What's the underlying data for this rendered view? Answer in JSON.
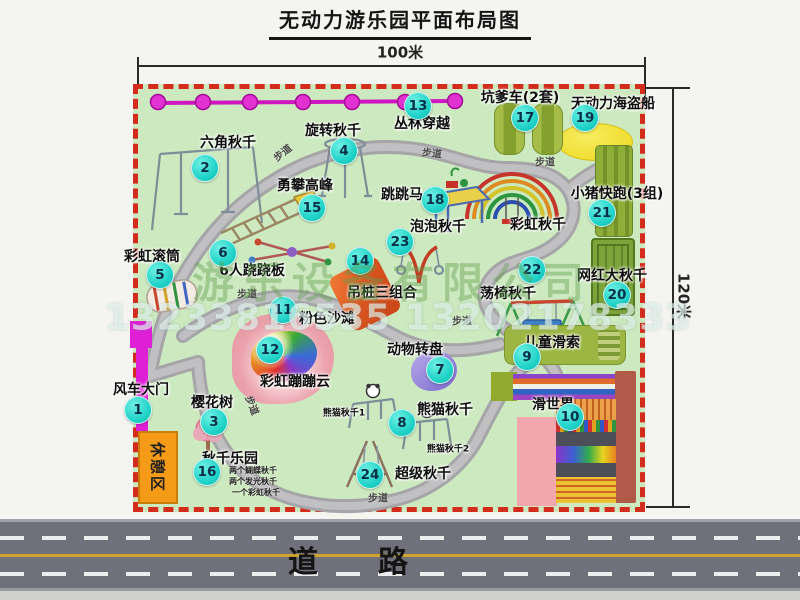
{
  "title": "无动力游乐园平面布局图",
  "dimensions": {
    "width": "100米",
    "height": "120米"
  },
  "road_label": "道　　路",
  "watermark": {
    "company": "游乐设备有限公司",
    "phone": "13233816535 13202178333"
  },
  "park": {
    "rest_area": "休憩区",
    "path_label": "步道",
    "rainbow_swing": "彩虹秋千",
    "panda_swing_1": "熊猫秋千1",
    "panda_swing_2": "熊猫秋千2",
    "swing_park_notes": [
      "两个蝴蝶秋千",
      "两个发光秋千",
      "一个彩虹秋千"
    ]
  },
  "markers": [
    {
      "num": "1",
      "label": "风车大门"
    },
    {
      "num": "2",
      "label": "六角秋千"
    },
    {
      "num": "3",
      "label": "樱花树"
    },
    {
      "num": "4",
      "label": "旋转秋千"
    },
    {
      "num": "5",
      "label": "彩虹滚筒"
    },
    {
      "num": "6",
      "label": "6人跷跷板"
    },
    {
      "num": "7",
      "label": "动物转盘"
    },
    {
      "num": "8",
      "label": "熊猫秋千"
    },
    {
      "num": "9",
      "label": "儿童滑索"
    },
    {
      "num": "10",
      "label": "滑世界"
    },
    {
      "num": "11",
      "label": "粉色沙滩"
    },
    {
      "num": "12",
      "label": "彩虹蹦蹦云"
    },
    {
      "num": "13",
      "label": "丛林穿越"
    },
    {
      "num": "14",
      "label": "吊桩三组合"
    },
    {
      "num": "15",
      "label": "勇攀高峰"
    },
    {
      "num": "16",
      "label": "秋千乐园"
    },
    {
      "num": "17",
      "label": "坑爹车(2套)"
    },
    {
      "num": "18",
      "label": "跳跳马"
    },
    {
      "num": "19",
      "label": "无动力海盗船"
    },
    {
      "num": "20",
      "label": "网红大秋千"
    },
    {
      "num": "21",
      "label": "小猪快跑(3组)"
    },
    {
      "num": "22",
      "label": "荡椅秋千"
    },
    {
      "num": "23",
      "label": "泡泡秋千"
    },
    {
      "num": "24",
      "label": "超级秋千"
    }
  ],
  "colors": {
    "park_green": "#cde9bf",
    "border_red": "#d32b1c",
    "marker_cyan": "#21d3c8",
    "zipline_magenta": "#cf16c0",
    "road_gray": "#70707a",
    "rest_orange": "#f59b17"
  }
}
